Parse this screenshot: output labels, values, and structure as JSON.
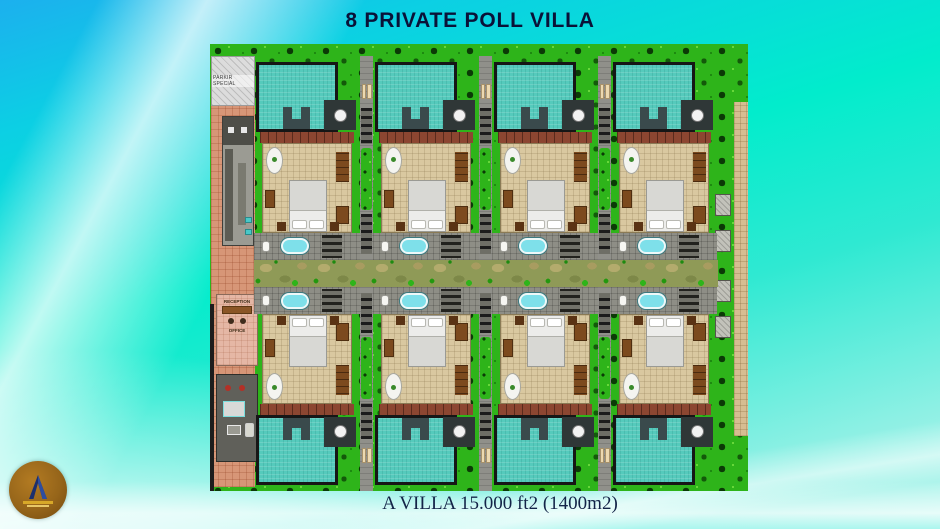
{
  "title": "8 PRIVATE POLL VILLA",
  "caption": "A VILLA 15.000 ft2 (1400m2)",
  "logo": {
    "monogram": "A"
  },
  "plan": {
    "rows": 2,
    "villas_per_row": 4,
    "labels": {
      "parking": "PARKIR SPECIAL",
      "reception": "RECEPTION",
      "office": "OFFICE"
    }
  },
  "colors": {
    "background_azure": "#1cb0ee",
    "background_turquoise": "#02eccc",
    "grass_green": "#2eb41a",
    "pool_water": "#55cabc",
    "deck_wood": "#8c4631",
    "bedroom_floor": "#d9c8a0",
    "stone_gray": "#90908a",
    "path_salmon": "#d79677",
    "title_text": "#0a1238"
  }
}
